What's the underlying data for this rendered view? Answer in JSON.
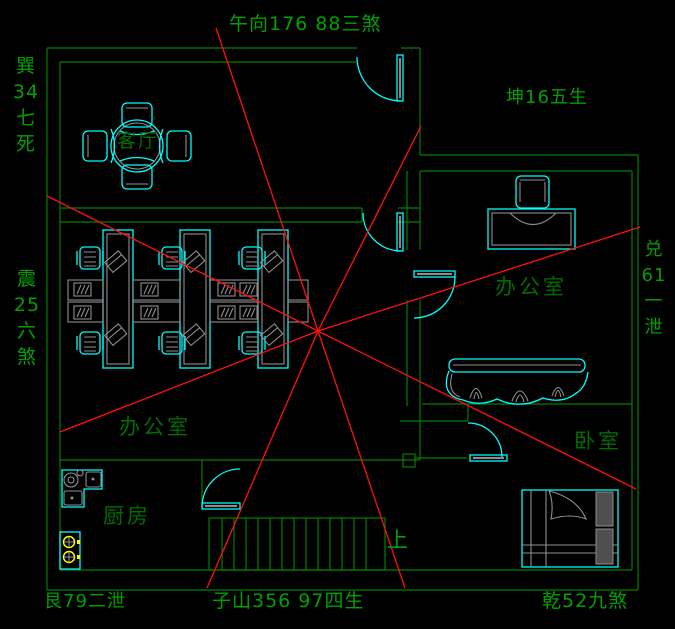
{
  "colors": {
    "background": "#000000",
    "wall_green": "#008000",
    "label_green": "#00a000",
    "room_label_green": "#006d00",
    "furniture_cyan": "#00ffff",
    "detail_gray": "#8f8f8f",
    "pillow_gray": "#4f4f4f",
    "ray_red": "#ff0f0f",
    "burner_yellow": "#ffff00",
    "door_white": "#e0e0e0"
  },
  "compass_labels": {
    "top": "午向176  88三煞",
    "top_left": "巽\n34\n七\n死",
    "top_right": "坤16五生",
    "left": "震\n25\n六\n煞",
    "right": "兑\n61\n一\n泄",
    "bottom_left": "艮79二泄",
    "bottom_center": "子山356  97四生",
    "bottom_right": "乾52九煞"
  },
  "room_labels": {
    "living_room": "客厅",
    "open_office": "办公室",
    "private_office": "办公室",
    "kitchen": "厨房",
    "bedroom": "卧室",
    "stairs_up": "上"
  }
}
